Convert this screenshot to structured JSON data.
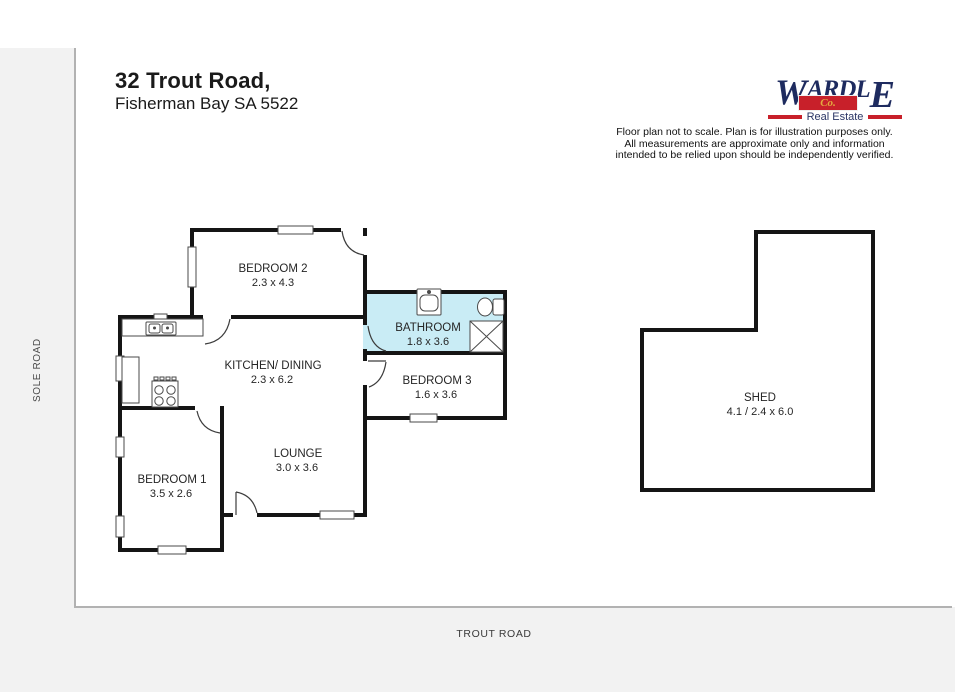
{
  "header": {
    "title": "32 Trout Road,",
    "subtitle": "Fisherman Bay SA 5522"
  },
  "logo": {
    "word_w": "W",
    "word_mid": "ARDL",
    "word_e": "E",
    "co": "Co.",
    "tagline": "Real Estate",
    "navy": "#1e2b5f",
    "red": "#c8202a",
    "gold": "#e3aa3f"
  },
  "disclaimer": {
    "line1": "Floor plan not to scale. Plan is for illustration purposes only.",
    "line2": "All measurements are approximate only and information",
    "line3": "intended to be relied upon should be independently verified."
  },
  "roads": {
    "left": "SOLE ROAD",
    "bottom": "TROUT ROAD"
  },
  "rooms": [
    {
      "name": "BEDROOM 2",
      "dims": "2.3 x 4.3"
    },
    {
      "name": "BATHROOM",
      "dims": "1.8 x 3.6"
    },
    {
      "name": "KITCHEN/ DINING",
      "dims": "2.3 x 6.2"
    },
    {
      "name": "BEDROOM 3",
      "dims": "1.6 x 3.6"
    },
    {
      "name": "LOUNGE",
      "dims": "3.0 x 3.6"
    },
    {
      "name": "BEDROOM 1",
      "dims": "3.5 x 2.6"
    },
    {
      "name": "SHED",
      "dims": "4.1 / 2.4 x 6.0"
    }
  ],
  "colors": {
    "wall": "#151515",
    "bathroom_fill": "#c9ecf5",
    "boundary_line": "#b2b2b2"
  }
}
